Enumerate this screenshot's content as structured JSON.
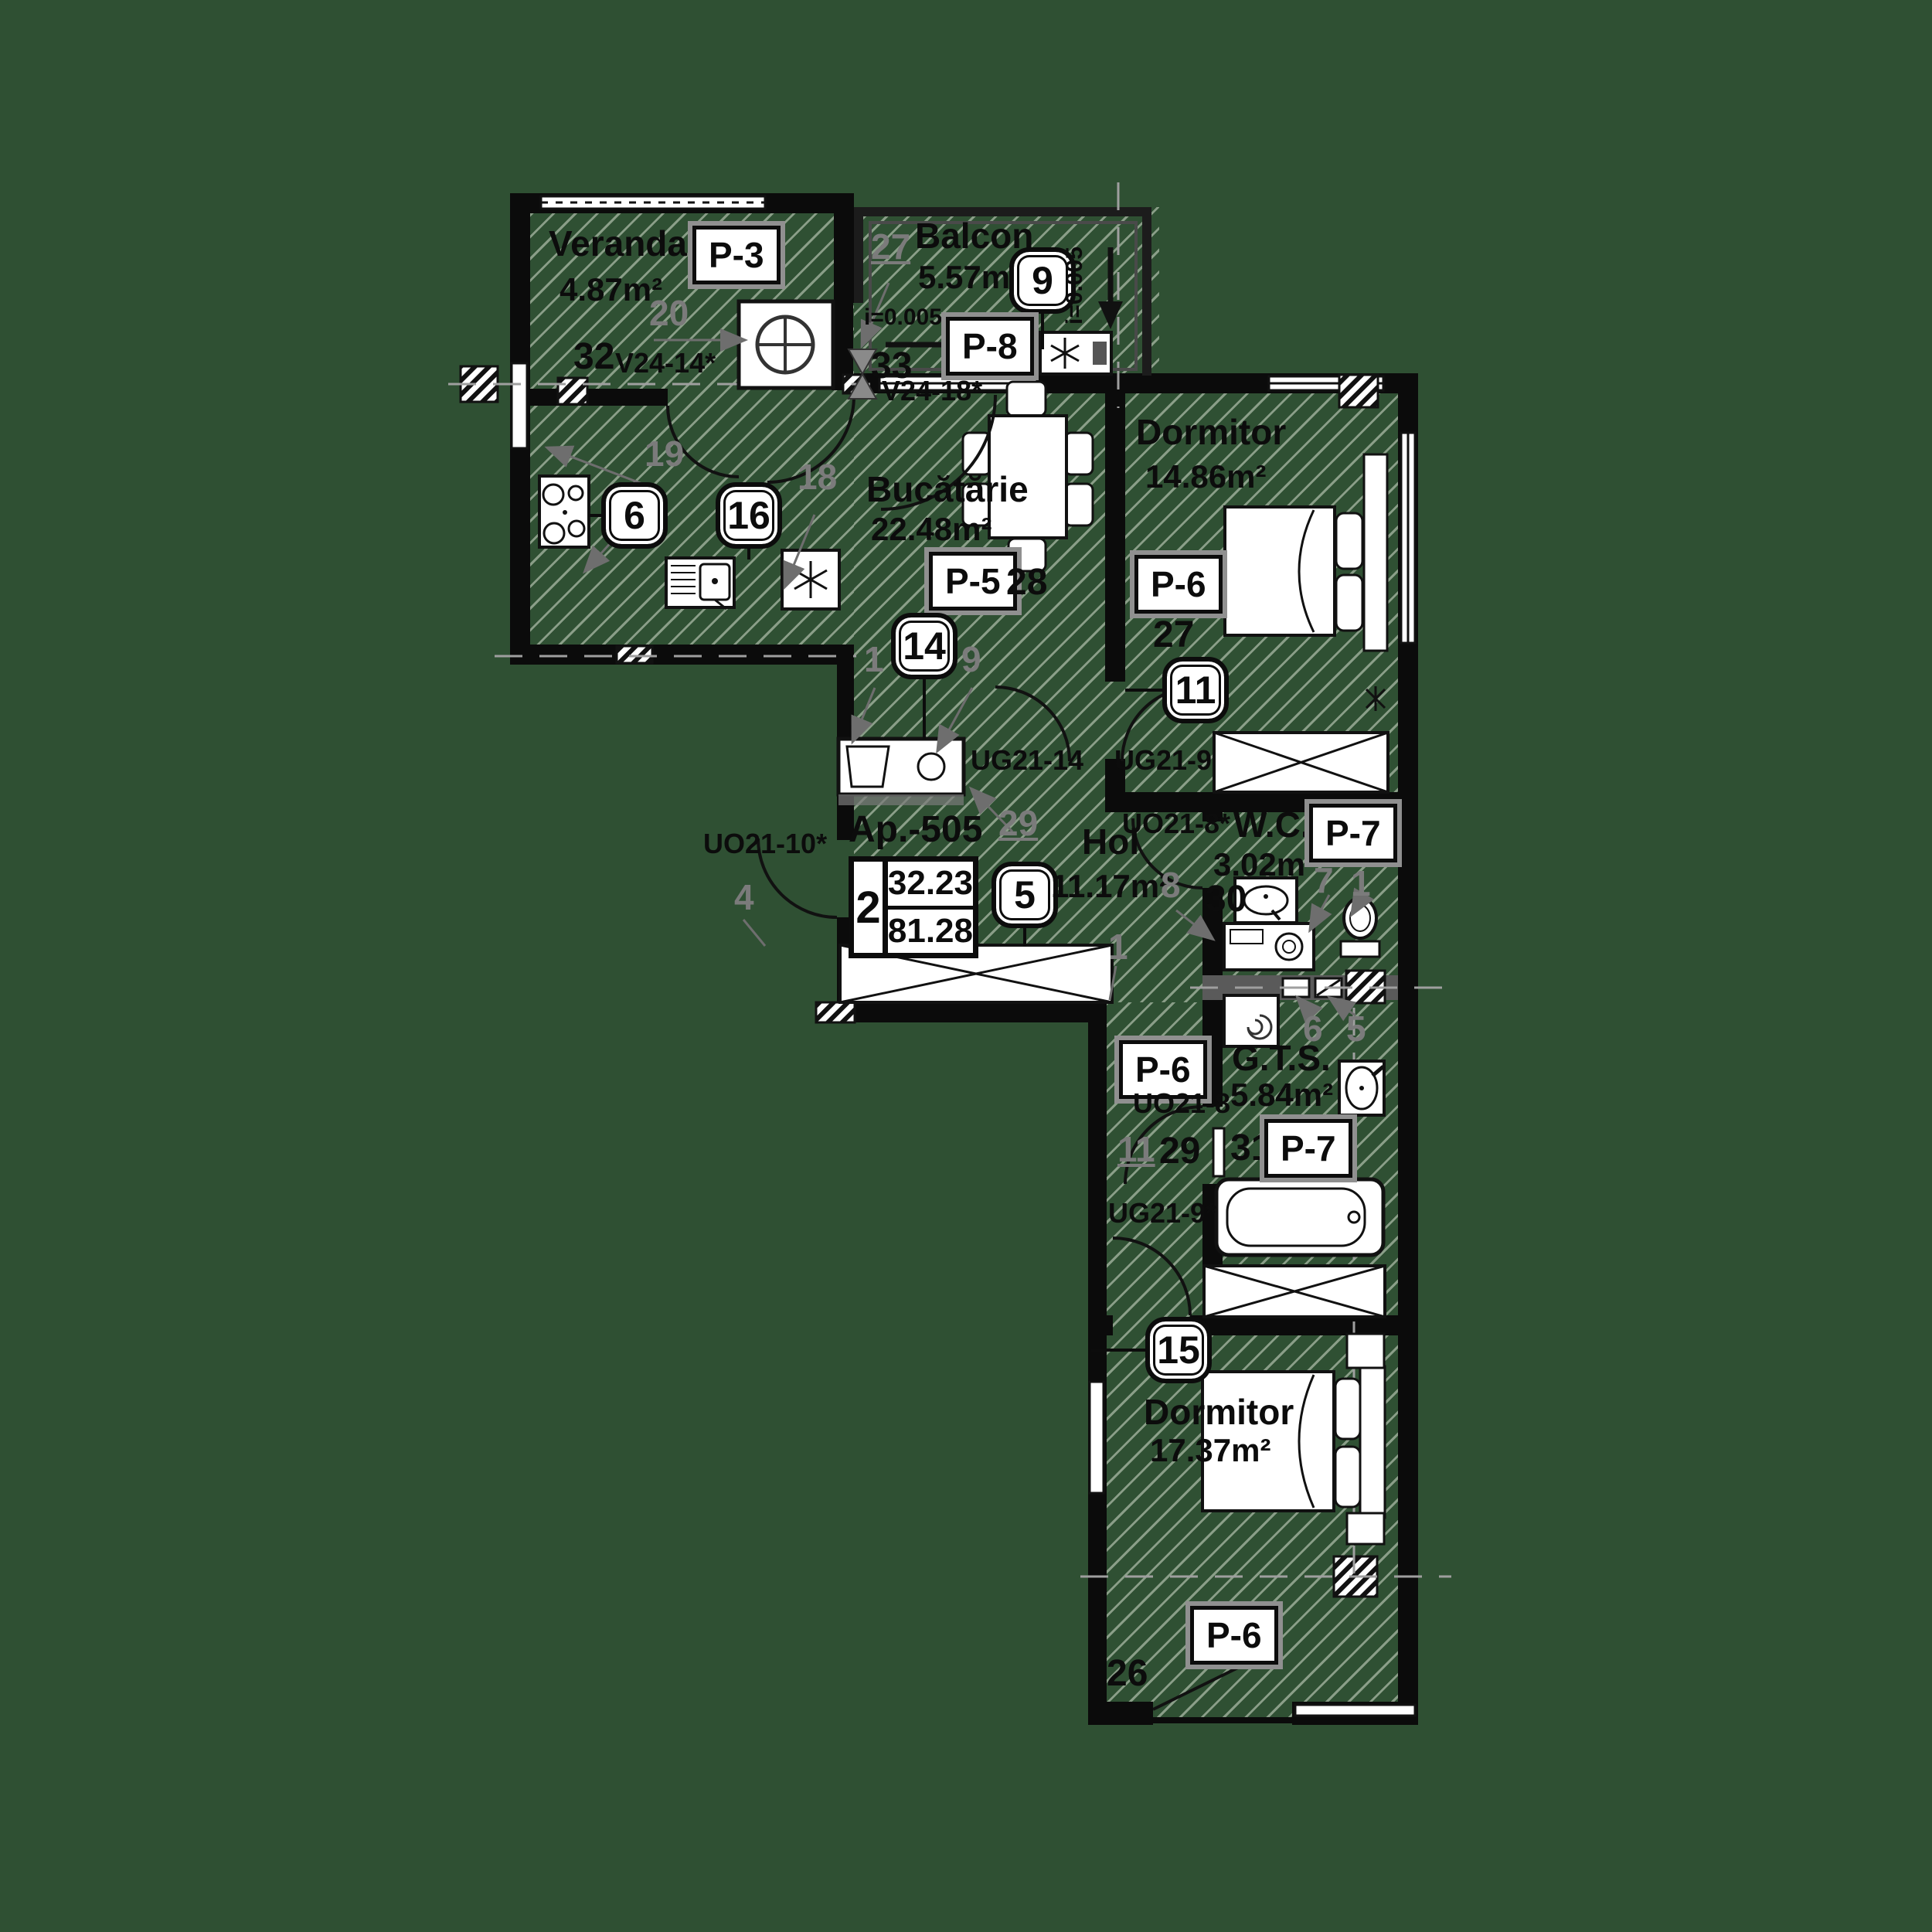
{
  "colors": {
    "background": "#2f5033",
    "wall": "#0b0b0b",
    "hatch_line": "#d5dece",
    "annotation_gray": "#7b7b7b"
  },
  "apartment": {
    "label": "Ap.-505",
    "rooms_count": "2",
    "area_useful": "32.23",
    "area_total": "81.28"
  },
  "slope_label": "i=0.005",
  "rooms": {
    "veranda": {
      "name": "Veranda",
      "area": "4.87m²",
      "panel": "P-3",
      "window_code": "V24-14*",
      "marks": {
        "pos20": "20",
        "pos32": "32",
        "pos19": "19"
      }
    },
    "balcon": {
      "name": "Balcon",
      "area": "5.57m²",
      "panel": "P-8",
      "badge": "9",
      "marks": {
        "pos27": "27",
        "pos33": "33"
      }
    },
    "bucatarie": {
      "name": "Bucătărie",
      "area": "22.48m²",
      "panel": "P-5",
      "window_code": "V24-18*",
      "badge": "14",
      "badge_stove": "6",
      "badge_sink": "16",
      "marks": {
        "pos18": "18",
        "pos28": "28",
        "pos1": "1",
        "pos9": "9"
      }
    },
    "dormitor1": {
      "name": "Dormitor",
      "area": "14.86m²",
      "panel": "P-6",
      "door_code": "UG21-9",
      "badge": "11",
      "marks": {
        "pos27": "27"
      }
    },
    "hol": {
      "name": "Hol",
      "area": "11.17m²",
      "entry_code": "UO21-10*",
      "door_code": "UG21-14",
      "badge": "5",
      "marks": {
        "pos29": "29",
        "pos4": "4",
        "pos1": "1"
      }
    },
    "wc": {
      "name": "W.C.",
      "area": "3.02m²",
      "panel": "P-7",
      "door_code": "UO21-8*",
      "marks": {
        "pos30": "30",
        "pos7": "7",
        "pos1": "1",
        "pos8": "8",
        "pos6": "6",
        "pos5": "5"
      }
    },
    "hall": {
      "panel": "P-6",
      "door_code": "UG21-9*",
      "marks": {
        "pos11": "11",
        "pos29": "29"
      }
    },
    "gts": {
      "name": "G.T.S.",
      "area": "5.84m²",
      "panel": "P-7",
      "door_code": "UO21-8",
      "marks": {
        "pos31": "31"
      }
    },
    "dormitor2": {
      "name": "Dormitor",
      "area": "17.37m²",
      "panel": "P-6",
      "badge": "15",
      "marks": {
        "pos26": "26"
      }
    }
  }
}
